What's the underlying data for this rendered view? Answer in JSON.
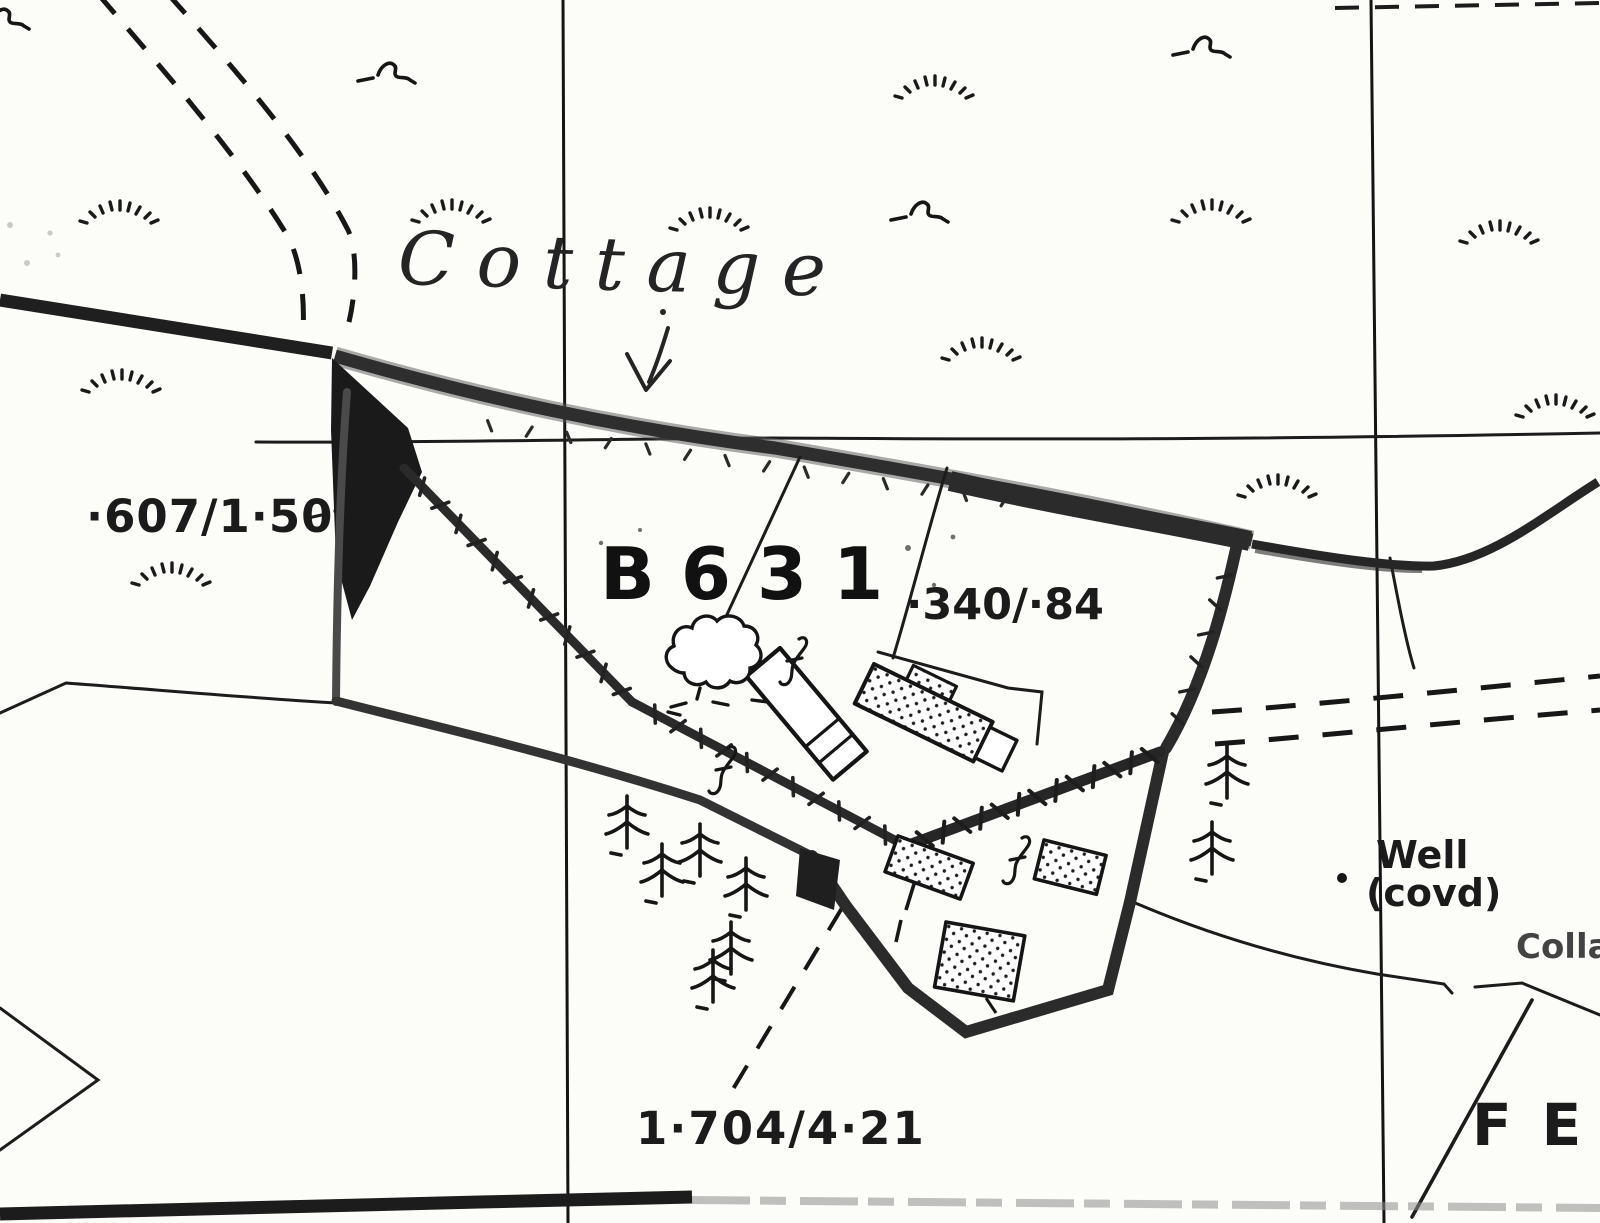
{
  "document": {
    "type": "scanned-estate-map",
    "background": "#fcfcf9",
    "ink": "#1b1b1b"
  },
  "annotations": {
    "handwritten_label": "Cottage",
    "arrow": "pencil-arrow-down"
  },
  "labels": {
    "area_ref_left": "·607/1·50",
    "parcel_number": "B631",
    "area_ref_center": "·340/·84",
    "area_ref_bottom": "1·704/4·21",
    "well_name": "Well",
    "well_qualifier": "(covd)",
    "fence_mark": "FE",
    "right_edge_partial": "Colla"
  },
  "symbols": {
    "deciduous_tree_count": 1,
    "conifer_count": 8,
    "grass_tuft_count": 11,
    "rough_pasture_marks": 4,
    "well_marker": "dot",
    "icon_names": [
      "tree-icon",
      "conifer-icon",
      "grass-tuft-icon",
      "rough-pasture-squiggle-icon",
      "brace-icon",
      "well-dot",
      "pencil-arrow-icon"
    ]
  },
  "colors": {
    "paper": "#fcfcf9",
    "ink": "#1b1b1b",
    "boundary_band": "#2e2e2e",
    "faded_grey": "#8d8d8d"
  }
}
